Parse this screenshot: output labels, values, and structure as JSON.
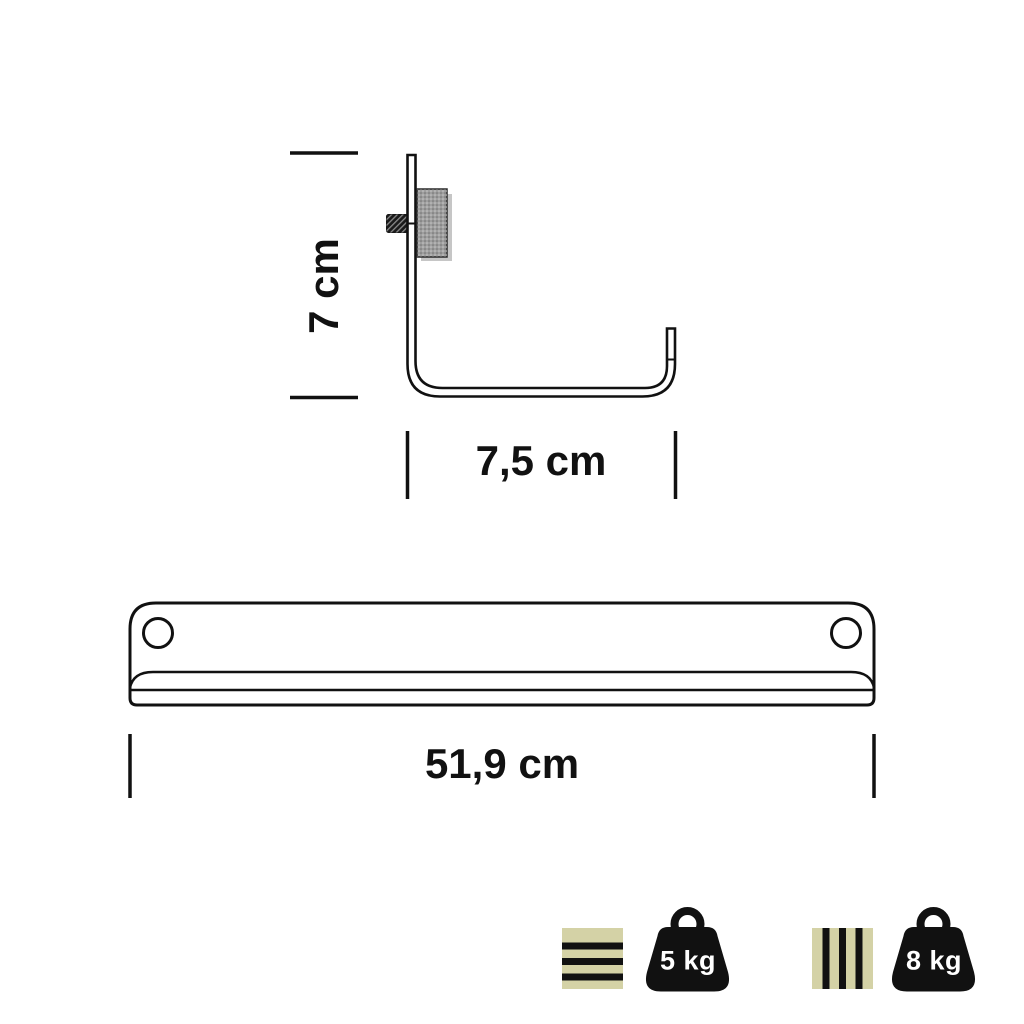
{
  "hook_view": {
    "height_label": "7 cm",
    "depth_label": "7,5 cm"
  },
  "rail_view": {
    "width_label": "51,9 cm"
  },
  "capacity": {
    "items": [
      {
        "pattern_icon": "horizontal-stripes-icon",
        "weight_icon": "kettlebell-weight-icon",
        "label": "5 kg"
      },
      {
        "pattern_icon": "vertical-stripes-icon",
        "weight_icon": "kettlebell-weight-icon",
        "label": "8 kg"
      }
    ]
  },
  "colors": {
    "line": "#111111",
    "stripe_fill": "#d4d2a6",
    "weight_fill": "#111111",
    "weight_text": "#ffffff",
    "knob_fill": "#9e9e9e",
    "knob_shadow": "#c6c6c6",
    "screw_fill": "#1a1a1a",
    "background": "#ffffff"
  }
}
